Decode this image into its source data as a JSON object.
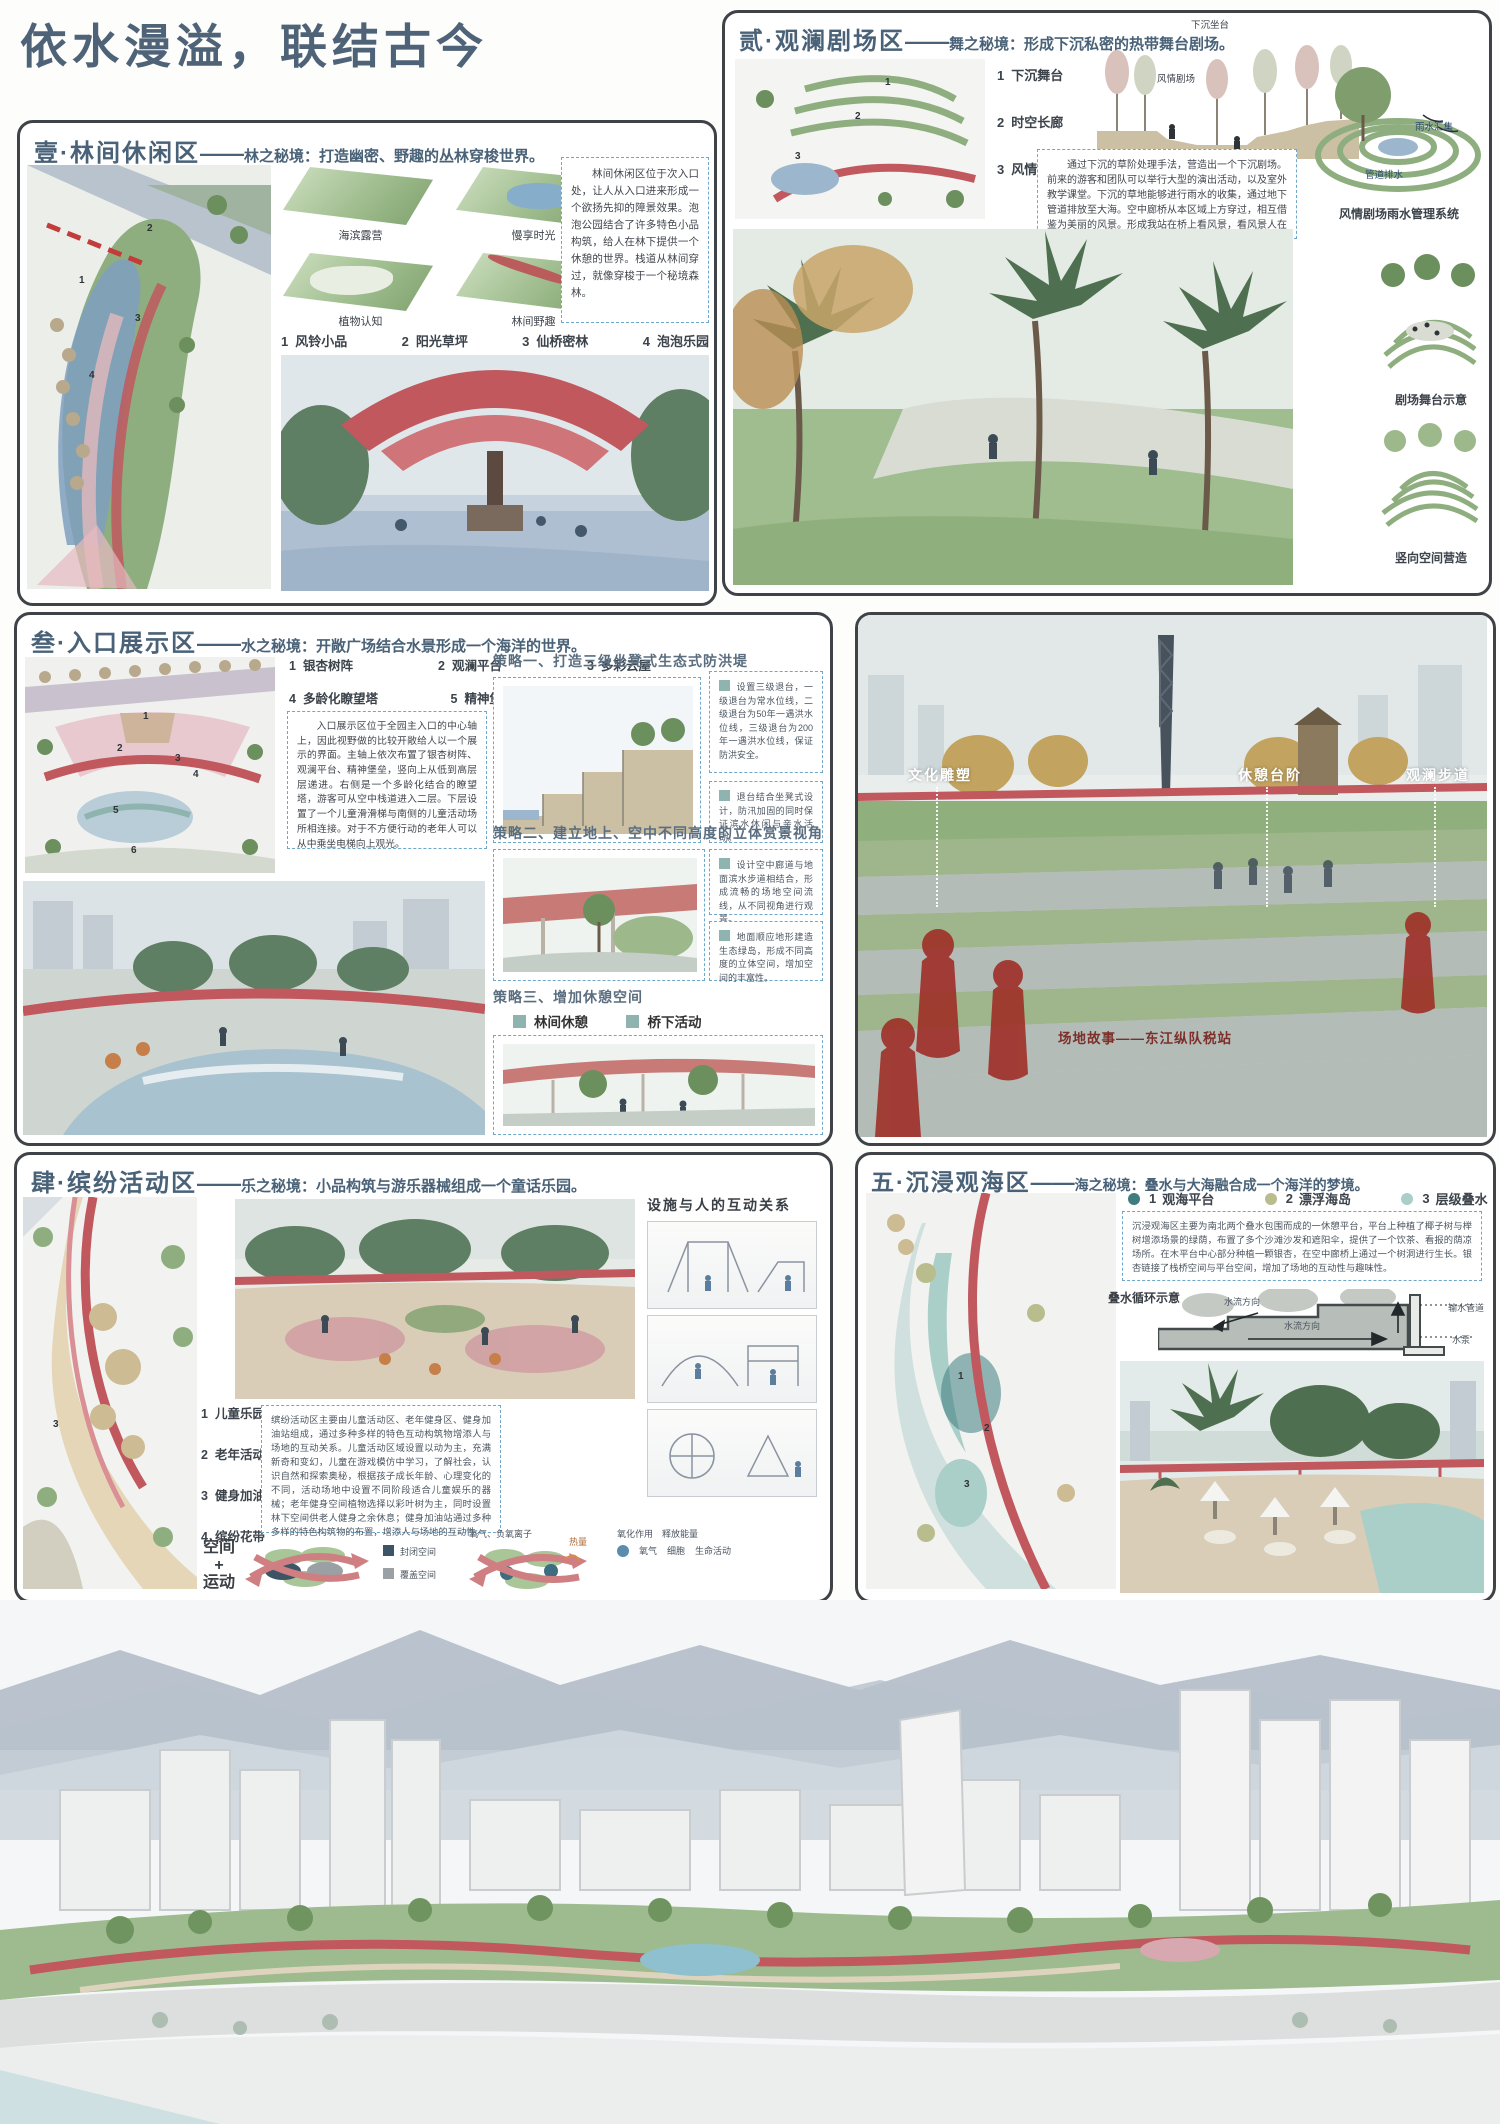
{
  "title": "依水漫溢，联结古今",
  "colors": {
    "heading": "#4a6278",
    "accent_red": "#c0585e",
    "dashed_border": "#6fa7cc",
    "tag_teal": "#8fb4af",
    "story_red": "#7d2f2a"
  },
  "panel1": {
    "zone": "壹·林间休闲区",
    "dash": "——",
    "sub": "林之秘境：打造幽密、野趣的丛林穿梭世界。",
    "thumbs": [
      {
        "label": "海滨露营"
      },
      {
        "label": "慢享时光"
      },
      {
        "label": "植物认知"
      },
      {
        "label": "林间野趣"
      }
    ],
    "list": [
      {
        "num": "1",
        "label": "风铃小品"
      },
      {
        "num": "2",
        "label": "阳光草坪"
      },
      {
        "num": "3",
        "label": "仙桥密林"
      },
      {
        "num": "4",
        "label": "泡泡乐园"
      }
    ],
    "paragraph": "林间休闲区位于次入口处，让人从入口进来形成一个欲扬先抑的障景效果。泡泡公园结合了许多特色小品构筑，给人在林下提供一个休憩的世界。栈道从林间穿过，就像穿梭于一个秘境森林。",
    "plan_markers": [
      "1",
      "2",
      "3",
      "4"
    ]
  },
  "panel2": {
    "zone": "贰·观澜剧场区",
    "dash": "——",
    "sub": "舞之秘境：形成下沉私密的热带舞台剧场。",
    "list": [
      {
        "num": "1",
        "label": "下沉舞台"
      },
      {
        "num": "2",
        "label": "时空长廊"
      },
      {
        "num": "3",
        "label": "风情剧场"
      }
    ],
    "section_label_top": "下沉坐台",
    "section_label_mid": "风情剧场",
    "paragraph": "通过下沉的草阶处理手法，营造出一个下沉剧场。前来的游客和团队可以举行大型的演出活动，以及室外教学课堂。下沉的草地能够进行雨水的收集，通过地下管道排放至大海。空中廊桥从本区域上方穿过，相互借鉴为美丽的风景。形成我站在桥上看风景，看风景人在桥下看你。",
    "rain_labels": [
      "雨水汇集",
      "管道排水"
    ],
    "captions": [
      "风情剧场雨水管理系统",
      "剧场舞台示意",
      "竖向空间营造"
    ],
    "plan_markers": [
      "1",
      "2",
      "3"
    ]
  },
  "panel3": {
    "zone": "叁·入口展示区",
    "dash": "——",
    "sub": "水之秘境：开敞广场结合水景形成一个海洋的世界。",
    "list": [
      {
        "num": "1",
        "label": "银杏树阵"
      },
      {
        "num": "2",
        "label": "观澜平台"
      },
      {
        "num": "3",
        "label": "多彩云屋"
      },
      {
        "num": "4",
        "label": "多龄化瞭望塔"
      },
      {
        "num": "5",
        "label": "精神堡垒"
      },
      {
        "num": "6",
        "label": "生态退台"
      }
    ],
    "paragraph": "入口展示区位于全园主入口的中心轴上，因此视野做的比较开敞给人以一个展示的界面。主轴上依次布置了银杏树阵、观澜平台、精神堡垒，竖向上从低到高层层递进。右侧是一个多龄化结合的瞭望塔，游客可从空中栈道进入二层。下层设置了一个儿童滑滑梯与南侧的儿童活动场所相连接。对于不方便行动的老年人可以从中乘坐电梯向上观光。",
    "strategy1": "策略一、打造三级坐凳式生态式防洪堤",
    "strategy1_notes": [
      "设置三级退台，一级退台为常水位线，二级退台为50年一遇洪水位线，三级退台为200年一遇洪水位线，保证防洪安全。",
      "退台结合坐凳式设计，防汛加固的同时保证滨水休闲与亲水活动。"
    ],
    "strategy2": "策略二、建立地上、空中不同高度的立体赏景视角",
    "strategy2_notes": [
      "设计空中廊道与地面滨水步道相结合，形成流畅的场地空间流线，从不同视角进行观景。",
      "地面顺应地形建造生态绿岛，形成不同高度的立体空间，增加空间的丰富性。"
    ],
    "strategy3": "策略三、增加休憩空间",
    "strategy3_tags": [
      "林间休憩",
      "桥下活动",
      "桥上观景"
    ],
    "plan_markers": [
      "1",
      "2",
      "3",
      "4",
      "5",
      "6"
    ]
  },
  "panel4": {
    "labels": [
      "文化雕塑",
      "休憩台阶",
      "观澜步道"
    ],
    "story": "场地故事——东江纵队税站"
  },
  "panel5": {
    "zone": "肆·缤纷活动区",
    "dash": "——",
    "sub": "乐之秘境：小品构筑与游乐器械组成一个童话乐园。",
    "interaction_title": "设施与人的互动关系",
    "list": [
      {
        "num": "1",
        "label": "儿童乐园"
      },
      {
        "num": "2",
        "label": "老年活动场"
      },
      {
        "num": "3",
        "label": "健身加油站"
      },
      {
        "num": "4",
        "label": "缤纷花带"
      }
    ],
    "paragraph": "缤纷活动区主要由儿童活动区、老年健身区、健身加油站组成，通过多种多样的特色互动构筑物增添人与场地的互动关系。儿童活动区域设置以动为主，充满新奇和变幻，儿童在游戏模仿中学习，了解社会，认识自然和探索奥秘，根据孩子成长年龄、心理变化的不同，活动场地中设置不同阶段适合儿童娱乐的器械；老年健身空间植物选择以彩叶树为主，同时设置林下空间供老人健身之余休息；健身加油站通过多种多样的特色构筑物的布置，增添人与场地的互动性。",
    "space_motion": [
      "空间",
      "+",
      "运动"
    ],
    "space_legend": [
      {
        "label": "封闭空间",
        "color": "#3d5466"
      },
      {
        "label": "覆盖空间",
        "color": "#9aa0a3"
      }
    ],
    "flow_labels": {
      "oxygen_ion": "氧气、负氧离子",
      "heat": "热量",
      "oxidation": "氧化作用",
      "release": "释放能量",
      "oxygen": "氧气",
      "cell": "细胞",
      "life": "生命活动"
    },
    "plan_marker": "3"
  },
  "panel6": {
    "zone": "五·沉浸观海区",
    "dash": "——",
    "sub": "海之秘境：叠水与大海融合成一个海洋的梦境。",
    "legend": [
      {
        "num": "1",
        "label": "观海平台",
        "color": "#3e7c80"
      },
      {
        "num": "2",
        "label": "漂浮海岛",
        "color": "#b9bd8e"
      },
      {
        "num": "3",
        "label": "层级叠水",
        "color": "#a9cfc8"
      }
    ],
    "paragraph": "沉浸观海区主要为南北两个叠水包围而成的一休憩平台，平台上种植了椰子树与榉树增添场景的绿荫，布置了多个沙滩沙发和遮阳伞，提供了一个饮茶、看报的荫凉场所。在木平台中心部分种植一颗银杏，在空中廊桥上通过一个树洞进行生长。银杏链接了栈桥空间与平台空间，增加了场地的互动性与趣味性。",
    "diagram_title": "叠水循环示意",
    "diagram_labels": {
      "flow1": "水流方向",
      "flow2": "水流方向",
      "pipe": "输水管道",
      "pump": "水泵"
    },
    "plan_markers": [
      "1",
      "2",
      "3"
    ]
  }
}
